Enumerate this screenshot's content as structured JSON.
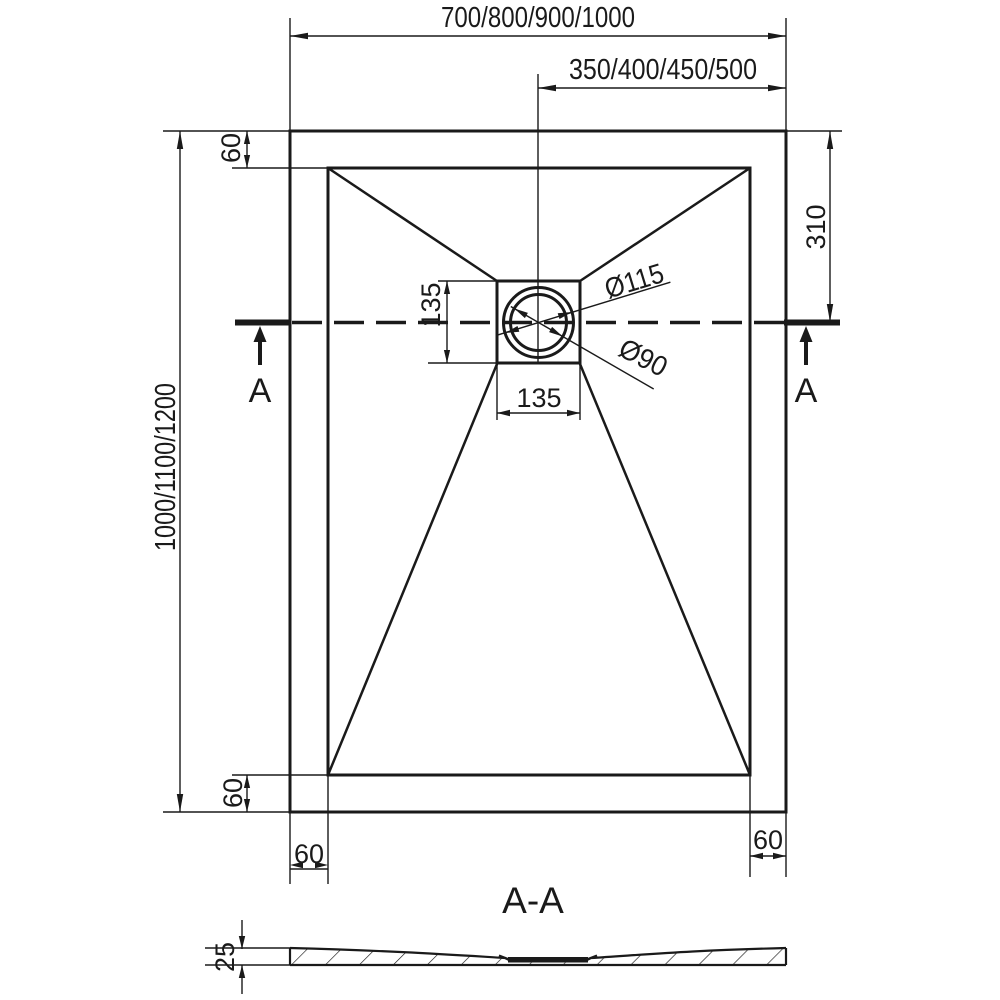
{
  "drawing_title": "A-A",
  "plan": {
    "width_options": "700/800/900/1000",
    "drain_offset_from_right": "350/400/450/500",
    "length_options": "1000/1100/1200",
    "top_rim_margin": "60",
    "bottom_rim_margin": "60",
    "bottom_left_rim_margin": "60",
    "bottom_right_rim_margin": "60",
    "drain_center_from_top": "310",
    "drain_square_height": "135",
    "drain_square_width": "135",
    "drain_outer_diameter": "Ø115",
    "drain_inner_diameter": "Ø90",
    "section_marker_left": "A",
    "section_marker_right": "A"
  },
  "section": {
    "title": "A-A",
    "thickness": "25"
  },
  "colors": {
    "line": "#1a1a1a",
    "background": "#ffffff"
  }
}
